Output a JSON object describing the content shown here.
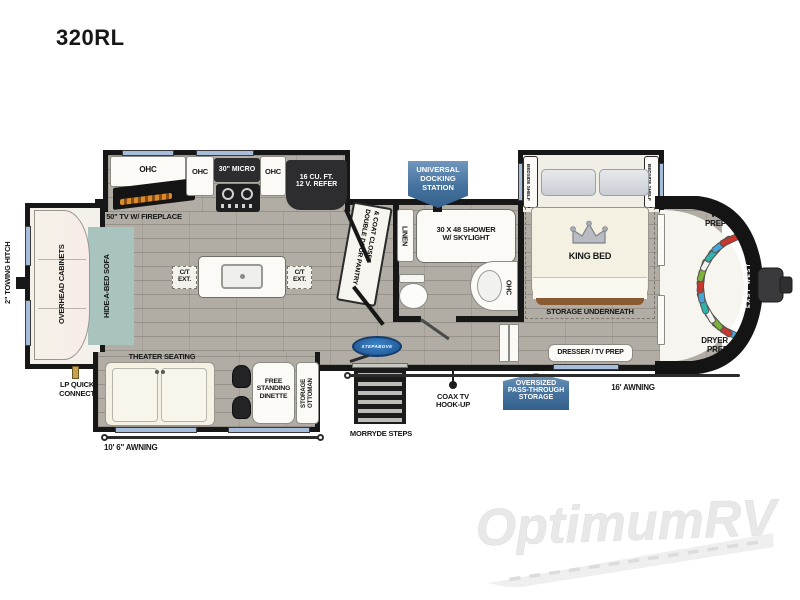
{
  "title": "320RL",
  "labels": {
    "towing_hitch": "2\" TOWING HITCH",
    "overhead_cabinets": "OVERHEAD CABINETS",
    "hide_a_bed_sofa": "HIDE-A-BED SOFA",
    "lp_quick_connect": [
      "LP QUICK",
      "CONNECT"
    ],
    "ohc": "OHC",
    "tv_fireplace": "50\" TV W/ FIREPLACE",
    "micro": "30\" MICRO",
    "refer": [
      "16 CU. FT.",
      "12 V. REFER"
    ],
    "ct": "C/T",
    "ext": "EXT.",
    "pantry": [
      "DOUBLE DOOR PANTRY",
      "& COAT CLOSET"
    ],
    "linen": "LINEN",
    "shower": [
      "30 X 48 SHOWER",
      "W/ SKYLIGHT"
    ],
    "bedside_shelf": "BEDSIDE SHELF",
    "king_bed": "KING BED",
    "storage_underneath": "STORAGE UNDERNEATH",
    "dresser_tv_prep": "DRESSER / TV PREP",
    "wd_prep": [
      "W/D",
      "PREP"
    ],
    "dryer_prep": [
      "DRYER",
      "PREP"
    ],
    "theater_seating": "THEATER SEATING",
    "free_standing_dinette": [
      "FREE",
      "STANDING",
      "DINETTE"
    ],
    "storage_ottoman": [
      "STORAGE",
      "OTTOMAN"
    ],
    "awning_left": "10' 6\" AWNING",
    "awning_right": "16' AWNING",
    "morryde_steps": "MORRYDE STEPS",
    "coax": [
      "COAX TV",
      "HOOK-UP"
    ]
  },
  "badges": {
    "docking": [
      "UNIVERSAL",
      "DOCKING",
      "STATION"
    ],
    "passthrough": [
      "OVERSIZED",
      "PASS-THROUGH",
      "STORAGE"
    ]
  },
  "logos": {
    "step_above": "STEPABOVE",
    "brand": "EAST WEST",
    "watermark": "OptimumRV"
  },
  "colors": {
    "badge_blue": "#44719d",
    "teal": "#a9c4bf",
    "wall": "#171717",
    "floor": "#b1aca4",
    "crown_silver": "#b9bcc2",
    "morryde_blue": "#2a6db5",
    "watermark_gray": "#e9e9e9",
    "hangers": [
      "#45a7d9",
      "#c8372e",
      "#7cb23f",
      "#f2f2f2",
      "#2fb3ab"
    ]
  }
}
